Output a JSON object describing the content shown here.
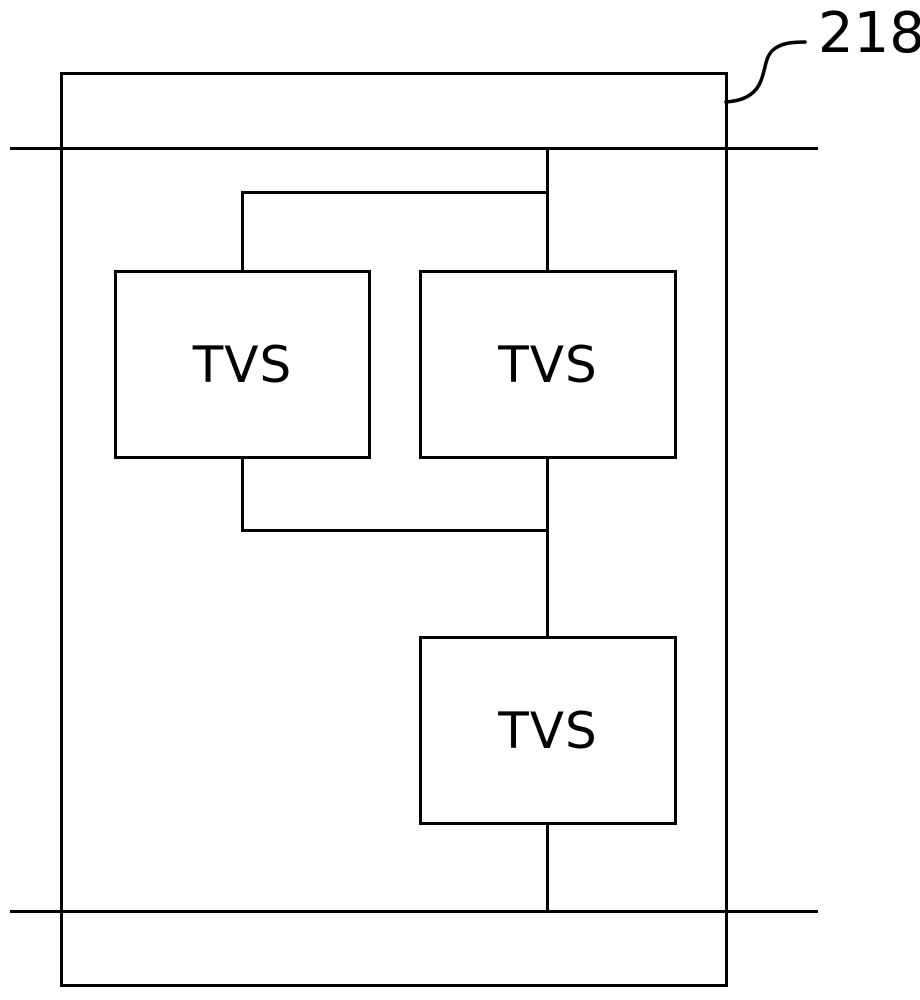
{
  "figure": {
    "reference_label": "218",
    "blocks": [
      {
        "label": "TVS"
      },
      {
        "label": "TVS"
      },
      {
        "label": "TVS"
      }
    ]
  },
  "colors": {
    "line": "#000000",
    "background": "#ffffff"
  }
}
